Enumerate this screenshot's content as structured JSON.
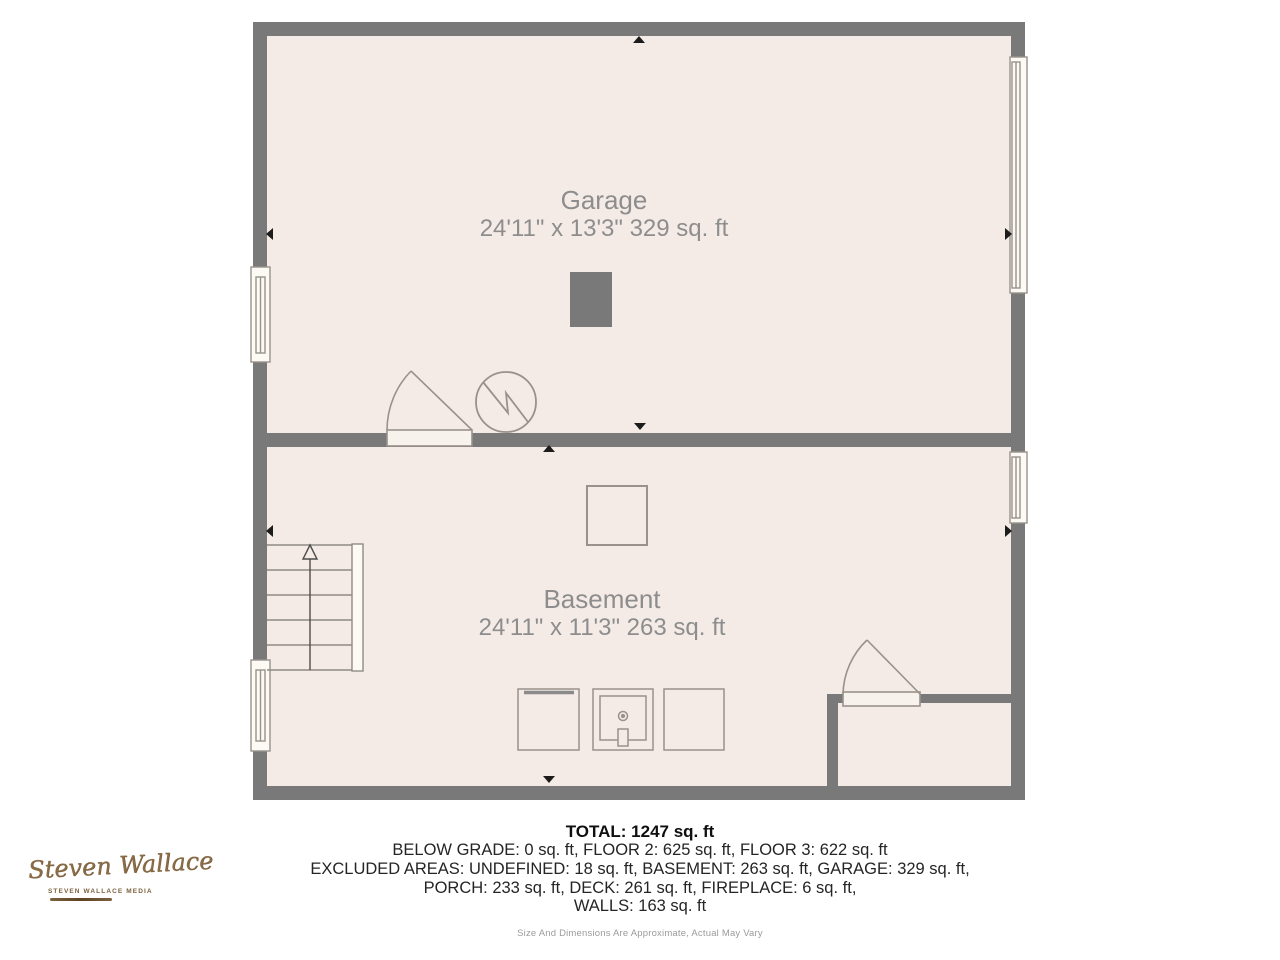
{
  "rooms": [
    {
      "name": "Garage",
      "dims": "24'11\" x 13'3\" 329 sq. ft"
    },
    {
      "name": "Basement",
      "dims": "24'11\" x 11'3\" 263 sq. ft"
    }
  ],
  "footer": {
    "total": "TOTAL: 1247 sq. ft",
    "lines": [
      "BELOW GRADE: 0 sq. ft, FLOOR 2: 625 sq. ft, FLOOR 3: 622 sq. ft",
      "EXCLUDED AREAS: UNDEFINED: 18 sq. ft, BASEMENT: 263 sq. ft, GARAGE: 329 sq. ft,",
      "PORCH: 233 sq. ft, DECK: 261 sq. ft, FIREPLACE: 6 sq. ft,",
      "WALLS: 163 sq. ft"
    ],
    "disclaimer": "Size And Dimensions Are Approximate, Actual May Vary"
  },
  "logo": {
    "name": "Steven Wallace",
    "tagline": "STEVEN WALLACE MEDIA"
  },
  "colors": {
    "wall": "#797979",
    "floor": "#f5ebe6",
    "symbol_stroke": "#98928b",
    "marker": "#1c1c1c",
    "room_label": "#8d8d8d",
    "logo_bronze": "#7d613f"
  },
  "symbols": {
    "stairs": "stairs-up-arrow",
    "doors": "door-swing-arc",
    "windows": "window-frame",
    "utility": "circle-zigzag-fan",
    "markers": "wall-measure-triangle"
  }
}
